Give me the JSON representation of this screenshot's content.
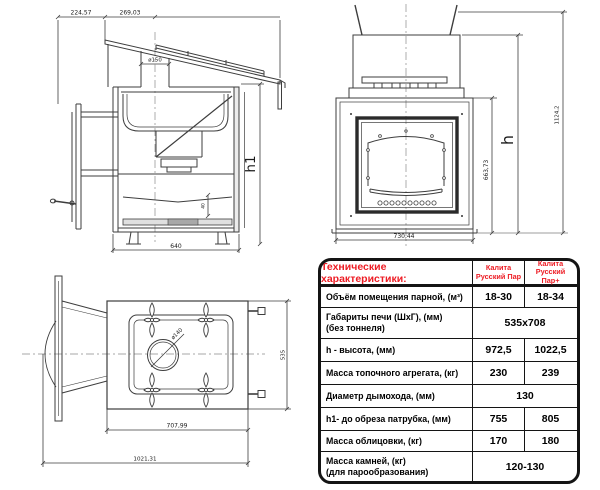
{
  "colors": {
    "accent_red": "#ed1c24",
    "line": "#3d3d3d"
  },
  "side_view": {
    "dim_top_left": "224,57",
    "dim_top_right": "269,03",
    "chimney_diameter": "ø150",
    "dim_height_h1": "h1",
    "dim_bottom_width": "640",
    "dim_small": "40"
  },
  "front_view": {
    "dim_total_height": "1124,2",
    "dim_h": "h",
    "dim_door_height": "663,73",
    "dim_bottom_width": "730,44"
  },
  "plan_view": {
    "hole_diameter": "ø140",
    "dim_depth": "535",
    "dim_width": "707,99",
    "dim_total_length": "1021,31"
  },
  "table": {
    "title": "Технические характеристики:",
    "col1_header": "Калита Русский Пар",
    "col2_header": "Калита Русский Пар+",
    "rows": [
      {
        "label": "Объём помещения парной, (м³)",
        "v1": "18-30",
        "v2": "18-34"
      },
      {
        "label": "Габариты печи (ШхГ), (мм)",
        "label2": "(без тоннеля)",
        "value": "535x708"
      },
      {
        "label": "h - высота, (мм)",
        "v1": "972,5",
        "v2": "1022,5"
      },
      {
        "label": "Масса топочного агрегата, (кг)",
        "v1": "230",
        "v2": "239"
      },
      {
        "label": "Диаметр дымохода, (мм)",
        "value": "130"
      },
      {
        "label": "h1- до обреза патрубка, (мм)",
        "v1": "755",
        "v2": "805"
      },
      {
        "label": "Масса облицовки, (кг)",
        "v1": "170",
        "v2": "180"
      },
      {
        "label": "Масса камней, (кг)",
        "label2": "(для парообразования)",
        "value": "120-130"
      }
    ]
  }
}
